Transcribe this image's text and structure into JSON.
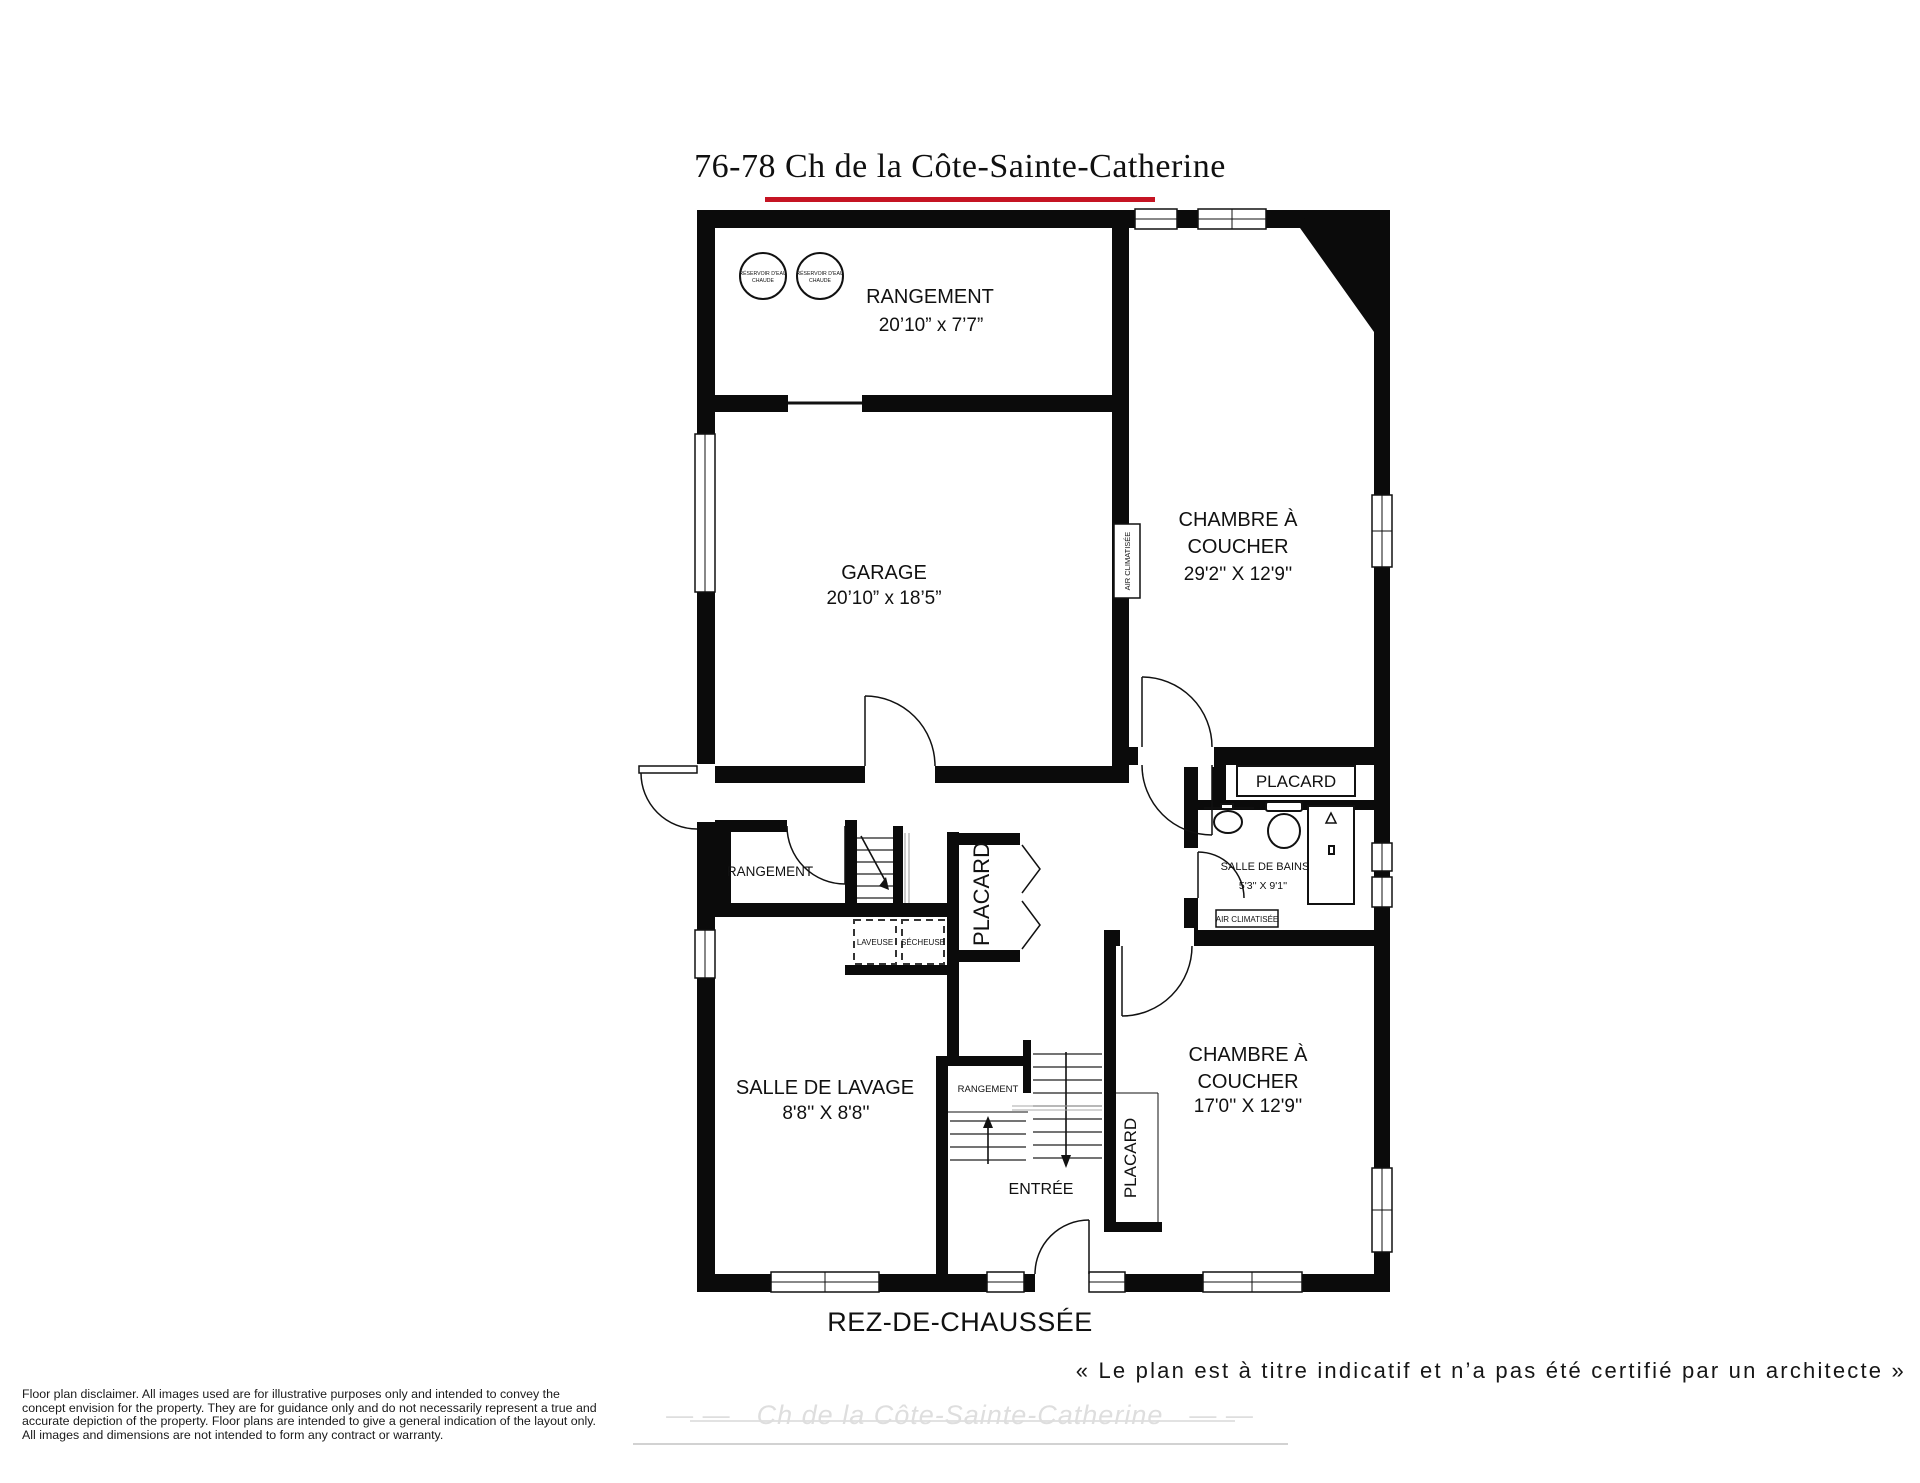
{
  "header": {
    "title": "76-78 Ch de la Côte-Sainte-Catherine",
    "underline_color": "#c51423"
  },
  "plan": {
    "rooms": {
      "rangement_haut": {
        "label": "RANGEMENT",
        "dims": "20’10” x 7’7”"
      },
      "garage": {
        "label": "GARAGE",
        "dims": "20’10” x 18’5”"
      },
      "chambre_haut": {
        "label_line1": "CHAMBRE À",
        "label_line2": "COUCHER",
        "dims": "29'2'' X 12'9''"
      },
      "placard_haut": {
        "label": "PLACARD"
      },
      "salle_de_bains": {
        "label": "SALLE DE BAINS",
        "dims": "5'3'' X 9'1''"
      },
      "rangement_milieu": {
        "label": "RANGEMENT"
      },
      "placard_milieu": {
        "label": "PLACARD"
      },
      "salle_de_lavage": {
        "label": "SALLE DE LAVAGE",
        "dims": "8'8'' X 8'8''"
      },
      "rangement_bas": {
        "label": "RANGEMENT"
      },
      "entree": {
        "label": "ENTRÉE"
      },
      "placard_bas": {
        "label": "PLACARD"
      },
      "chambre_bas": {
        "label_line1": "CHAMBRE À",
        "label_line2": "COUCHER",
        "dims": "17'0'' X 12'9''"
      }
    },
    "fixtures": {
      "tank_label_line1": "RÉSERVOIR D'EAU",
      "tank_label_line2": "CHAUDE",
      "ac_wall_unit": "AIR CLIMATISÉE",
      "ac_room_unit": "AIR CLIMATISÉE",
      "laveuse": "LAVEUSE",
      "secheuse": "SÉCHEUSE"
    }
  },
  "footer": {
    "floor_label": "REZ-DE-CHAUSSÉE",
    "note": "« Le plan est à titre indicatif et n’a pas été certifié par un architecte »",
    "watermark_text": "Ch de la Côte-Sainte-Catherine",
    "watermark_dashes": "—  —",
    "disclaimer_lines": [
      "Floor plan disclaimer. All images used are for illustrative purposes only and intended to convey the",
      "concept envision for the property. They are for guidance only and do not necessarily represent a true and",
      "accurate depiction of the property. Floor plans are intended to give a general indication of the layout only.",
      "All images and dimensions are not intended to form any contract or warranty."
    ]
  }
}
